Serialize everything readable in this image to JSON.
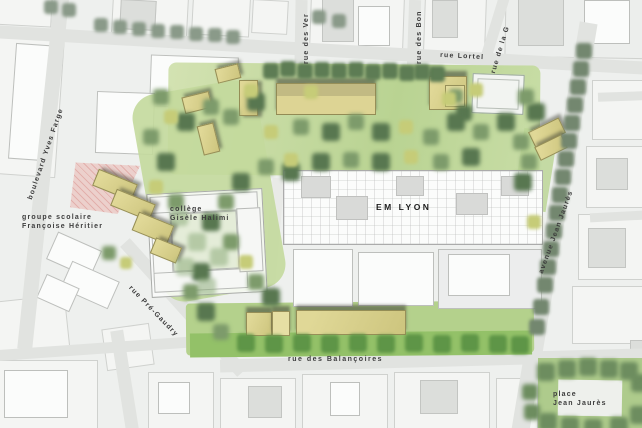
{
  "map": {
    "labels": {
      "boulevard": "boulevard Yves Farge",
      "rue_des_ver": "rue des Ver",
      "rue_des_bon": "rue des Bon",
      "rue_de_la_g": "rue de la G",
      "rue_lortel": "rue Lortel",
      "avenue_jean_jaures": "avenue Jean Jaurès",
      "groupe_scolaire_line1": "groupe scolaire",
      "groupe_scolaire_line2": "Françoise Héritier",
      "college_line1": "collège",
      "college_line2": "Gisèle Halimi",
      "em_lyon": "EM LYON",
      "rue_pre_gaudry": "rue Pré-Gaudry",
      "rue_des_balancoires": "rue des Balançoires",
      "place_line1": "place",
      "place_line2": "Jean Jaurès"
    },
    "colors": {
      "park_green": "#bcd595",
      "bright_green": "#93c168",
      "tree_dark": "#5d7c54",
      "tree_light": "#c6cc78",
      "new_building_khaki": "#d5cd88",
      "road_gray": "#e1e3e0",
      "plaza_pink": "#ecd0cc",
      "label_text": "#3c3c3c"
    }
  }
}
